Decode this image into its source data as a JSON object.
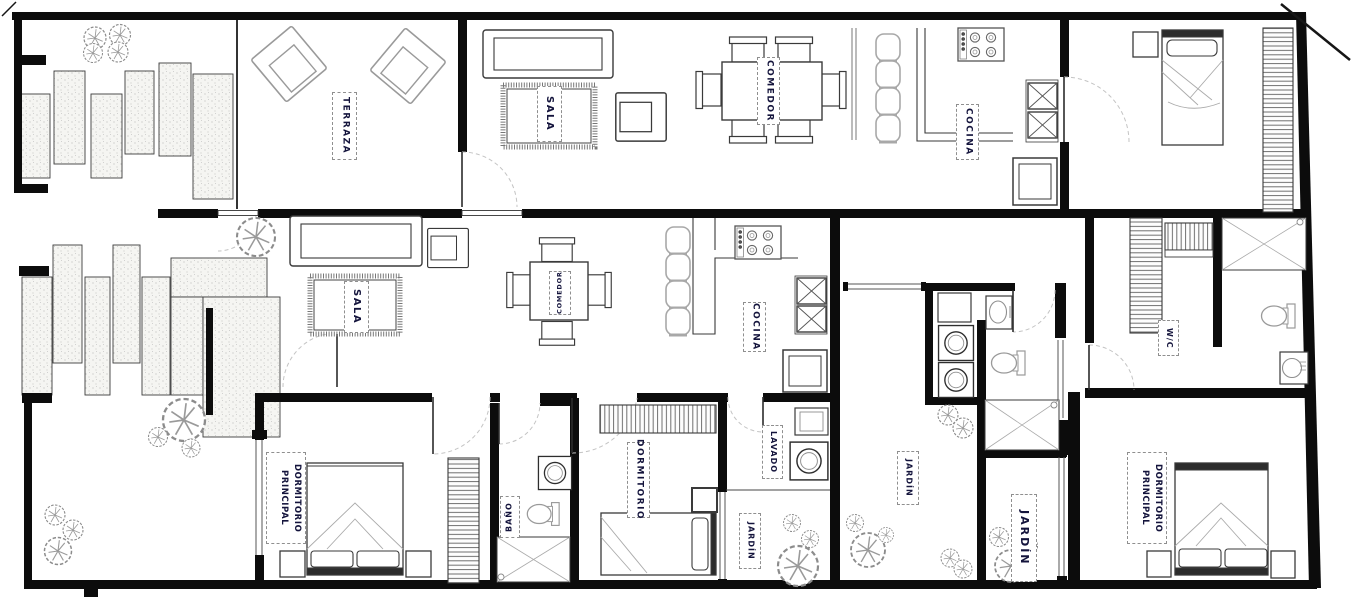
{
  "document": {
    "kind_hint": "architectural floor plan drawing"
  },
  "palette": {
    "wall": "#0c0c0c",
    "label_text": "#14143c",
    "furniture_dark": "#3a3a3a",
    "furniture_light": "#a0a0a0",
    "greenery": "#8c8c8c",
    "paver_fill": "#f5f5f2",
    "door_arc": "#c4c4c4"
  },
  "rooms": {
    "terraza": {
      "label": "TERRAZA"
    },
    "sala_upper": {
      "label": "SALA"
    },
    "comedor_upper": {
      "label": "COMEDOR"
    },
    "cocina_upper": {
      "label": "COCINA"
    },
    "sala_lower": {
      "label": "SALA"
    },
    "comedor_lower": {
      "label": "COMEDOR"
    },
    "cocina_lower": {
      "label": "COCINA"
    },
    "dormitorio_principal_left": {
      "label": "DORMITORIO PRINCIPAL"
    },
    "bano": {
      "label": "BAÑO"
    },
    "dormitorio": {
      "label": "DORMITORIO"
    },
    "lavado": {
      "label": "LAVADO"
    },
    "jardin_1": {
      "label": "JARDÍN"
    },
    "jardin_2": {
      "label": "JARDÍN"
    },
    "jardin_3": {
      "label": "JARDÍN"
    },
    "wc": {
      "label": "W/C"
    },
    "dormitorio_principal_right": {
      "label": "DORMITORIO PRINCIPAL"
    }
  }
}
